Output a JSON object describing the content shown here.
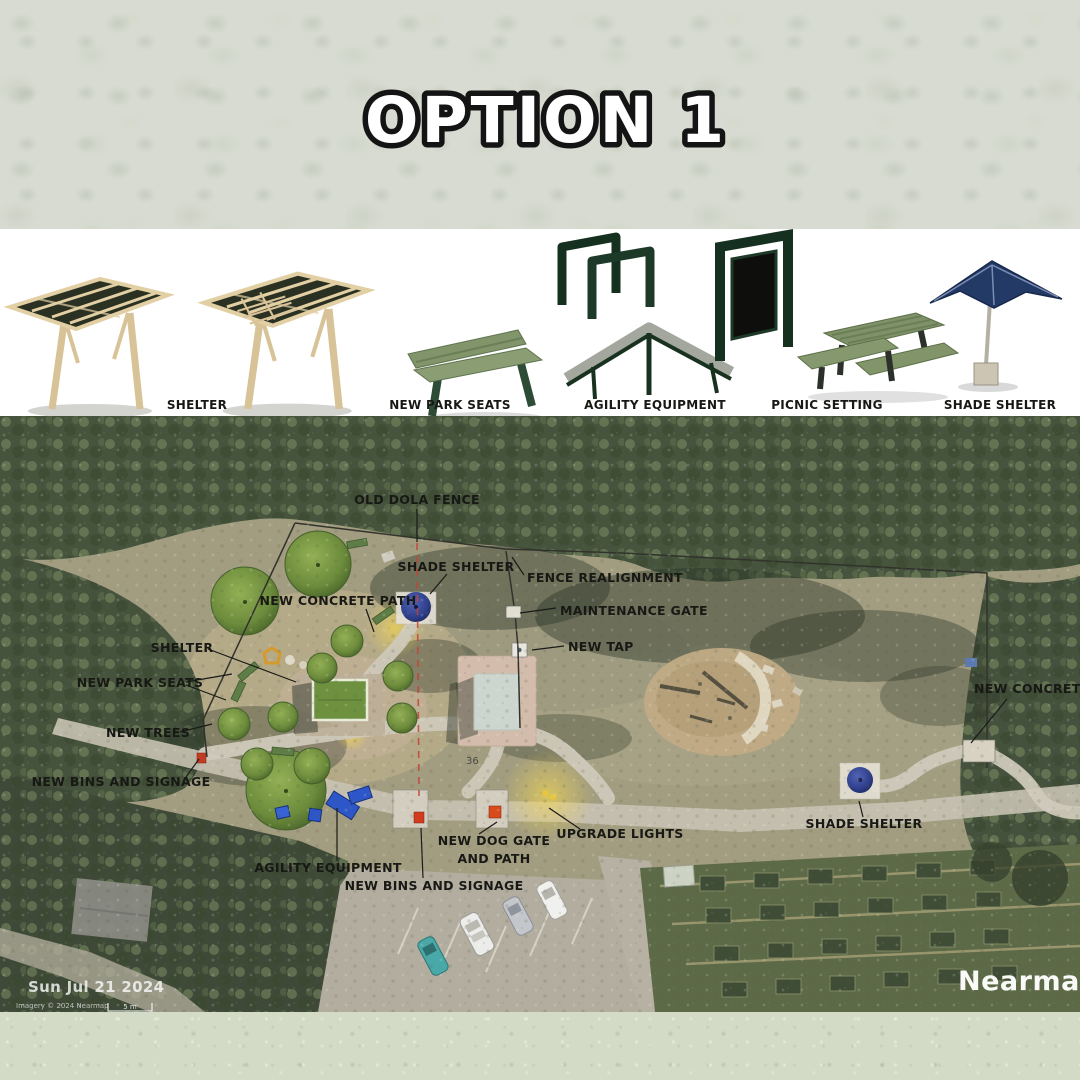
{
  "title": "OPTION 1",
  "legend": {
    "items": [
      {
        "label": "SHELTER",
        "icon": "pergola-shelter-icon"
      },
      {
        "label": "NEW PARK SEATS",
        "icon": "park-bench-icon"
      },
      {
        "label": "AGILITY EQUIPMENT",
        "icon": "dog-agility-icon"
      },
      {
        "label": "PICNIC SETTING",
        "icon": "picnic-table-icon"
      },
      {
        "label": "SHADE SHELTER",
        "icon": "shade-umbrella-icon"
      }
    ]
  },
  "map": {
    "labels": {
      "old_dola_fence": "OLD DOLA FENCE",
      "shade_shelter_top": "SHADE SHELTER",
      "fence_realignment": "FENCE REALIGNMENT",
      "maintenance_gate": "MAINTENANCE GATE",
      "new_tap": "NEW TAP",
      "new_concrete_path_left": "NEW CONCRETE PATH",
      "shelter": "SHELTER",
      "new_park_seats": "NEW PARK SEATS",
      "new_trees": "NEW TREES",
      "new_bins_left": "NEW BINS AND SIGNAGE",
      "agility_equipment": "AGILITY EQUIPMENT",
      "new_bins_bottom": "NEW BINS AND SIGNAGE",
      "new_dog_gate_line1": "NEW DOG GATE",
      "new_dog_gate_line2": "AND PATH",
      "upgrade_lights": "UPGRADE LIGHTS",
      "shade_shelter_right": "SHADE SHELTER",
      "new_concrete_path_right": "NEW CONCRETE PATH",
      "lot_number": "36"
    },
    "attribution": {
      "date": "Sun Jul 21 2024",
      "imagery": "Imagery © 2024 Nearmap",
      "scale": "5 m",
      "provider": "Nearmap"
    }
  },
  "colors": {
    "equipment_green": "#16301f",
    "agility_blue": "#2d57c9",
    "bin_red": "#d23b1e",
    "old_fence_red": "#c24434",
    "new_path_grey": "#cfc9ba",
    "shade_dome_blue": "#2f3f8c"
  }
}
